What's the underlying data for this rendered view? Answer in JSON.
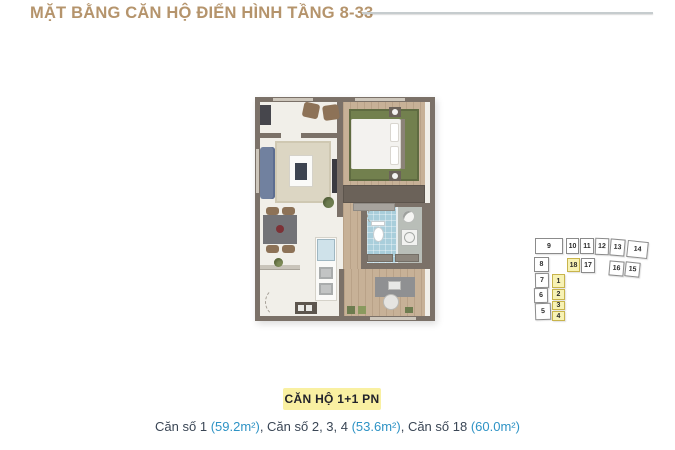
{
  "header": {
    "title": "MẶT BẰNG CĂN HỘ ĐIỂN HÌNH TẦNG 8-33"
  },
  "footer": {
    "badge_label": "CĂN HỘ 1+1 PN",
    "caption_segments": [
      {
        "text": "Căn số 1 ",
        "style": "dark"
      },
      {
        "text": "(59.2m²)",
        "style": "blue"
      },
      {
        "text": ", Căn số 2, 3, 4 ",
        "style": "dark"
      },
      {
        "text": "(53.6m²)",
        "style": "blue"
      },
      {
        "text": ", Căn số 18 ",
        "style": "dark"
      },
      {
        "text": "(60.0m²)",
        "style": "blue"
      }
    ]
  },
  "unit_locator": {
    "highlighted_units": [
      "18",
      "1",
      "2",
      "3",
      "4"
    ],
    "cells": [
      {
        "id": "9",
        "x": 5,
        "y": 6,
        "w": 28,
        "h": 16,
        "rot": 0,
        "highlighted": false
      },
      {
        "id": "10",
        "x": 36,
        "y": 6,
        "w": 13,
        "h": 16,
        "rot": 0,
        "highlighted": false
      },
      {
        "id": "11",
        "x": 50,
        "y": 6,
        "w": 14,
        "h": 16,
        "rot": 0,
        "highlighted": false
      },
      {
        "id": "12",
        "x": 65,
        "y": 6,
        "w": 14,
        "h": 17,
        "rot": 2,
        "highlighted": false
      },
      {
        "id": "13",
        "x": 80,
        "y": 7,
        "w": 15,
        "h": 17,
        "rot": 5,
        "highlighted": false
      },
      {
        "id": "14",
        "x": 97,
        "y": 9,
        "w": 21,
        "h": 17,
        "rot": 6,
        "highlighted": false
      },
      {
        "id": "8",
        "x": 4,
        "y": 25,
        "w": 15,
        "h": 15,
        "rot": 0,
        "highlighted": false
      },
      {
        "id": "18",
        "x": 37,
        "y": 26,
        "w": 13,
        "h": 14,
        "rot": 0,
        "highlighted": true
      },
      {
        "id": "17",
        "x": 51,
        "y": 26,
        "w": 14,
        "h": 15,
        "rot": 0,
        "highlighted": false
      },
      {
        "id": "16",
        "x": 79,
        "y": 29,
        "w": 15,
        "h": 15,
        "rot": 5,
        "highlighted": false
      },
      {
        "id": "15",
        "x": 95,
        "y": 30,
        "w": 15,
        "h": 15,
        "rot": 6,
        "highlighted": false
      },
      {
        "id": "7",
        "x": 5,
        "y": 41,
        "w": 14,
        "h": 15,
        "rot": -1,
        "highlighted": false
      },
      {
        "id": "6",
        "x": 4,
        "y": 56,
        "w": 14,
        "h": 15,
        "rot": -1,
        "highlighted": false
      },
      {
        "id": "5",
        "x": 5,
        "y": 71,
        "w": 16,
        "h": 17,
        "rot": -2,
        "highlighted": false
      },
      {
        "id": "1",
        "x": 22,
        "y": 42,
        "w": 13,
        "h": 14,
        "rot": 0,
        "highlighted": true
      },
      {
        "id": "2",
        "x": 22,
        "y": 57,
        "w": 13,
        "h": 11,
        "rot": 0,
        "highlighted": true
      },
      {
        "id": "3",
        "x": 22,
        "y": 69,
        "w": 13,
        "h": 9,
        "rot": 0,
        "highlighted": true
      },
      {
        "id": "4",
        "x": 22,
        "y": 79,
        "w": 13,
        "h": 10,
        "rot": 0,
        "highlighted": true
      }
    ]
  },
  "colors": {
    "title_gold": "#b5946c",
    "badge_bg": "#f9f0a2",
    "badge_text": "#22232b",
    "caption_text": "#3a4655",
    "caption_accent": "#2e93c5",
    "locator_highlight_bg": "#f7f2b4",
    "locator_highlight_border": "#c8b44c",
    "plan_wall": "#7b7168",
    "plan_wood_floor": "#c7b197",
    "plan_tile_blue": "#a9cedb",
    "plan_rug_green": "#72804e",
    "plan_rug_beige": "#dcd6c3",
    "plan_floor_ivory": "#f1efe9",
    "plan_sofa_blue": "#71819f"
  }
}
